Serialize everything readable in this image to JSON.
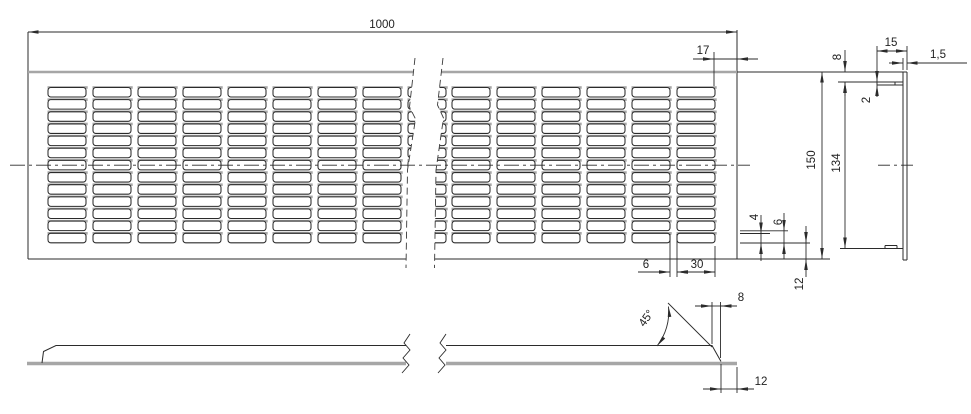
{
  "drawing": {
    "type": "technical-drawing",
    "part": "louvered ventilation grille plate"
  },
  "plan": {
    "length": "1000",
    "right_margin": "17",
    "height": "150",
    "slot_height": "4",
    "row_pitch": "6",
    "bottom_margin": "12",
    "slot_gap": "6",
    "slot_width": "30"
  },
  "side": {
    "flange_length": "15",
    "thickness": "1,5",
    "top_offset": "8",
    "flange_thickness": "2",
    "inner_height": "134"
  },
  "elevation": {
    "bend_offset": "8",
    "bend_angle": "45°",
    "edge_margin": "12"
  },
  "slots": {
    "columns": [
      48,
      93,
      138,
      183,
      228,
      273,
      318,
      363,
      408,
      452,
      497,
      542,
      587,
      632,
      677
    ],
    "col_width": 38,
    "rows": 13,
    "row_start": 87.5,
    "row_pitch": 12.15,
    "slot_height": 9.5
  },
  "colors": {
    "line": "#2b2b2b",
    "thick": "#a6a6a6",
    "bg": "#ffffff"
  }
}
